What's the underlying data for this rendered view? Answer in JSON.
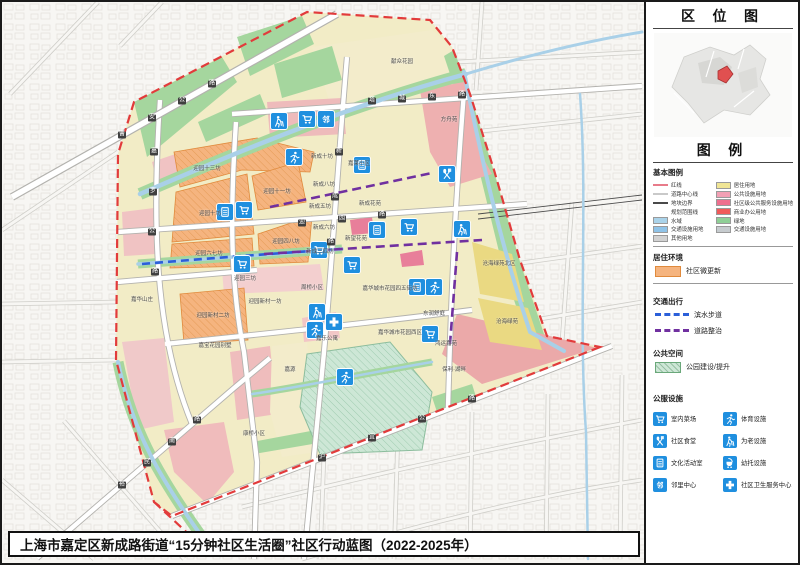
{
  "title_bar": {
    "text": "上海市嘉定区新成路街道“15分钟社区生活圈”社区行动蓝图（2022-2025年）"
  },
  "side_panel": {
    "location_title": "区 位 图",
    "legend_title": "图 例",
    "base_legend": {
      "heading": "基本图例",
      "left": [
        {
          "label": "红线",
          "sw": "line",
          "c": "#e87b8a"
        },
        {
          "label": "道路中心线",
          "sw": "line",
          "c": "#c9c9c9"
        },
        {
          "label": "地块边界",
          "sw": "line",
          "c": "#4a4a4a"
        },
        {
          "label": "规划范围线",
          "sw": "dash",
          "c": "#e23b3b"
        },
        {
          "label": "水域",
          "sw": "box",
          "c": "#aad3ea"
        },
        {
          "label": "交通设施用地",
          "sw": "box",
          "c": "#8fc3e8"
        },
        {
          "label": "其他用地",
          "sw": "box",
          "c": "#d2d2d2"
        }
      ],
      "right": [
        {
          "label": "居住用地",
          "sw": "box",
          "c": "#f0e595"
        },
        {
          "label": "公共设施用地",
          "sw": "box",
          "c": "#f2a0b4"
        },
        {
          "label": "社区级公共服务设施用地",
          "sw": "box",
          "c": "#ee6f8e"
        },
        {
          "label": "商业办公用地",
          "sw": "box",
          "c": "#f05a5a"
        },
        {
          "label": "绿地",
          "sw": "box",
          "c": "#8fcf96"
        },
        {
          "label": "交通设施用地",
          "sw": "box",
          "c": "#c6cbce"
        }
      ]
    },
    "sections": [
      {
        "heading": "居住环境",
        "items": [
          {
            "sw": "bbox",
            "c": "#f5b47f",
            "b": "#e08a3c",
            "label": "社区微更新"
          }
        ]
      },
      {
        "heading": "交通出行",
        "items": [
          {
            "sw": "bdash",
            "c": "#2b5fd9",
            "label": "滨水步道"
          },
          {
            "sw": "bdash",
            "c": "#7030a0",
            "label": "道路整治"
          }
        ]
      },
      {
        "heading": "公共空间",
        "items": [
          {
            "sw": "hatch",
            "c": "#cde7d6",
            "b": "#6aa87a",
            "label": "公园建设/提升"
          }
        ]
      }
    ],
    "facilities": {
      "heading": "公服设施",
      "items": [
        {
          "icon": "cart",
          "label": "室内菜场"
        },
        {
          "icon": "sport",
          "label": "体育设施"
        },
        {
          "icon": "canteen",
          "label": "社区食堂"
        },
        {
          "icon": "elder",
          "label": "为老设施"
        },
        {
          "icon": "culture",
          "label": "文化活动室"
        },
        {
          "icon": "stroller",
          "label": "幼托设施"
        },
        {
          "icon": "neighbor",
          "label": "邻里中心"
        },
        {
          "icon": "health",
          "label": "社区卫生服务中心"
        }
      ]
    }
  },
  "icons": {
    "neighbor_char": "邻"
  },
  "map": {
    "colors": {
      "facility_icon_blue": "#1f8fdf",
      "boundary_red": "#e23b3b",
      "waterfront_walkway_blue": "#2b5fd9",
      "road_improvement_purple": "#7030a0",
      "micro_renewal_orange": "#f5b47f"
    },
    "labels": [
      {
        "t": "迎园十三坊",
        "x": 205,
        "y": 167
      },
      {
        "t": "迎园十一坊",
        "x": 275,
        "y": 190
      },
      {
        "t": "迎园十坊",
        "x": 208,
        "y": 212
      },
      {
        "t": "迎园六七坊",
        "x": 207,
        "y": 252
      },
      {
        "t": "迎园四八坊",
        "x": 284,
        "y": 240
      },
      {
        "t": "迎园新村二坊",
        "x": 211,
        "y": 314
      },
      {
        "t": "迎园新村一坊",
        "x": 263,
        "y": 300
      },
      {
        "t": "迎园三坊",
        "x": 243,
        "y": 277
      },
      {
        "t": "新成十坊",
        "x": 320,
        "y": 155
      },
      {
        "t": "新成八坊",
        "x": 322,
        "y": 183
      },
      {
        "t": "新成五坊",
        "x": 318,
        "y": 205
      },
      {
        "t": "新成六坊",
        "x": 322,
        "y": 226
      },
      {
        "t": "新成三四坊",
        "x": 318,
        "y": 250
      },
      {
        "t": "嘉莱小区",
        "x": 357,
        "y": 162
      },
      {
        "t": "新成花苑",
        "x": 368,
        "y": 202
      },
      {
        "t": "新望花苑",
        "x": 354,
        "y": 237
      },
      {
        "t": "嘉华山庄",
        "x": 140,
        "y": 298
      },
      {
        "t": "嘉宝花园别墅",
        "x": 213,
        "y": 344
      },
      {
        "t": "嘉乐公寓",
        "x": 325,
        "y": 337
      },
      {
        "t": "嘉源",
        "x": 288,
        "y": 368
      },
      {
        "t": "康桥小区",
        "x": 252,
        "y": 432
      },
      {
        "t": "周桥小区",
        "x": 310,
        "y": 286
      },
      {
        "t": "嘉华城市花园四五街坊",
        "x": 388,
        "y": 287
      },
      {
        "t": "嘉华城市花园西区",
        "x": 398,
        "y": 331
      },
      {
        "t": "东润舒庭",
        "x": 432,
        "y": 312
      },
      {
        "t": "鸿运嘉苑",
        "x": 444,
        "y": 342
      },
      {
        "t": "保利·湖畔",
        "x": 452,
        "y": 368
      },
      {
        "t": "沧海绿苑北区",
        "x": 497,
        "y": 262
      },
      {
        "t": "沧海绿苑",
        "x": 505,
        "y": 320
      },
      {
        "t": "方舟苑",
        "x": 447,
        "y": 118
      },
      {
        "t": "献众花园",
        "x": 400,
        "y": 60
      }
    ],
    "road_chips": [
      {
        "t": "曹",
        "x": 120,
        "y": 133
      },
      {
        "t": "安",
        "x": 150,
        "y": 116
      },
      {
        "t": "公",
        "x": 180,
        "y": 99
      },
      {
        "t": "路",
        "x": 210,
        "y": 82
      },
      {
        "t": "嘉",
        "x": 152,
        "y": 150
      },
      {
        "t": "罗",
        "x": 151,
        "y": 190
      },
      {
        "t": "公",
        "x": 150,
        "y": 230
      },
      {
        "t": "路",
        "x": 153,
        "y": 270
      },
      {
        "t": "新",
        "x": 337,
        "y": 150
      },
      {
        "t": "成",
        "x": 333,
        "y": 195
      },
      {
        "t": "路",
        "x": 329,
        "y": 240
      },
      {
        "t": "迎",
        "x": 300,
        "y": 221
      },
      {
        "t": "园",
        "x": 340,
        "y": 217
      },
      {
        "t": "路",
        "x": 380,
        "y": 213
      },
      {
        "t": "塔",
        "x": 370,
        "y": 99
      },
      {
        "t": "城",
        "x": 400,
        "y": 97
      },
      {
        "t": "东",
        "x": 430,
        "y": 95
      },
      {
        "t": "路",
        "x": 460,
        "y": 93
      },
      {
        "t": "裕",
        "x": 120,
        "y": 483
      },
      {
        "t": "民",
        "x": 145,
        "y": 461
      },
      {
        "t": "南",
        "x": 170,
        "y": 440
      },
      {
        "t": "路",
        "x": 195,
        "y": 418
      },
      {
        "t": "沪",
        "x": 320,
        "y": 456
      },
      {
        "t": "宜",
        "x": 370,
        "y": 436
      },
      {
        "t": "公",
        "x": 420,
        "y": 417
      },
      {
        "t": "路",
        "x": 470,
        "y": 397
      }
    ],
    "facilities": [
      {
        "icon": "elder",
        "x": 277,
        "y": 119
      },
      {
        "icon": "cart",
        "x": 305,
        "y": 117
      },
      {
        "icon": "neighbor",
        "x": 324,
        "y": 117
      },
      {
        "icon": "sport",
        "x": 292,
        "y": 155
      },
      {
        "icon": "culture",
        "x": 360,
        "y": 163
      },
      {
        "icon": "canteen",
        "x": 445,
        "y": 172
      },
      {
        "icon": "culture",
        "x": 223,
        "y": 210
      },
      {
        "icon": "cart",
        "x": 242,
        "y": 208
      },
      {
        "icon": "culture",
        "x": 375,
        "y": 228
      },
      {
        "icon": "cart",
        "x": 407,
        "y": 225
      },
      {
        "icon": "elder",
        "x": 460,
        "y": 227
      },
      {
        "icon": "cart",
        "x": 317,
        "y": 248
      },
      {
        "icon": "cart",
        "x": 240,
        "y": 262
      },
      {
        "icon": "cart",
        "x": 350,
        "y": 263
      },
      {
        "icon": "culture",
        "x": 415,
        "y": 285
      },
      {
        "icon": "sport",
        "x": 432,
        "y": 285
      },
      {
        "icon": "elder",
        "x": 315,
        "y": 310
      },
      {
        "icon": "health",
        "x": 332,
        "y": 320
      },
      {
        "icon": "sport",
        "x": 313,
        "y": 328
      },
      {
        "icon": "cart",
        "x": 428,
        "y": 332
      },
      {
        "icon": "sport",
        "x": 343,
        "y": 375
      }
    ]
  }
}
